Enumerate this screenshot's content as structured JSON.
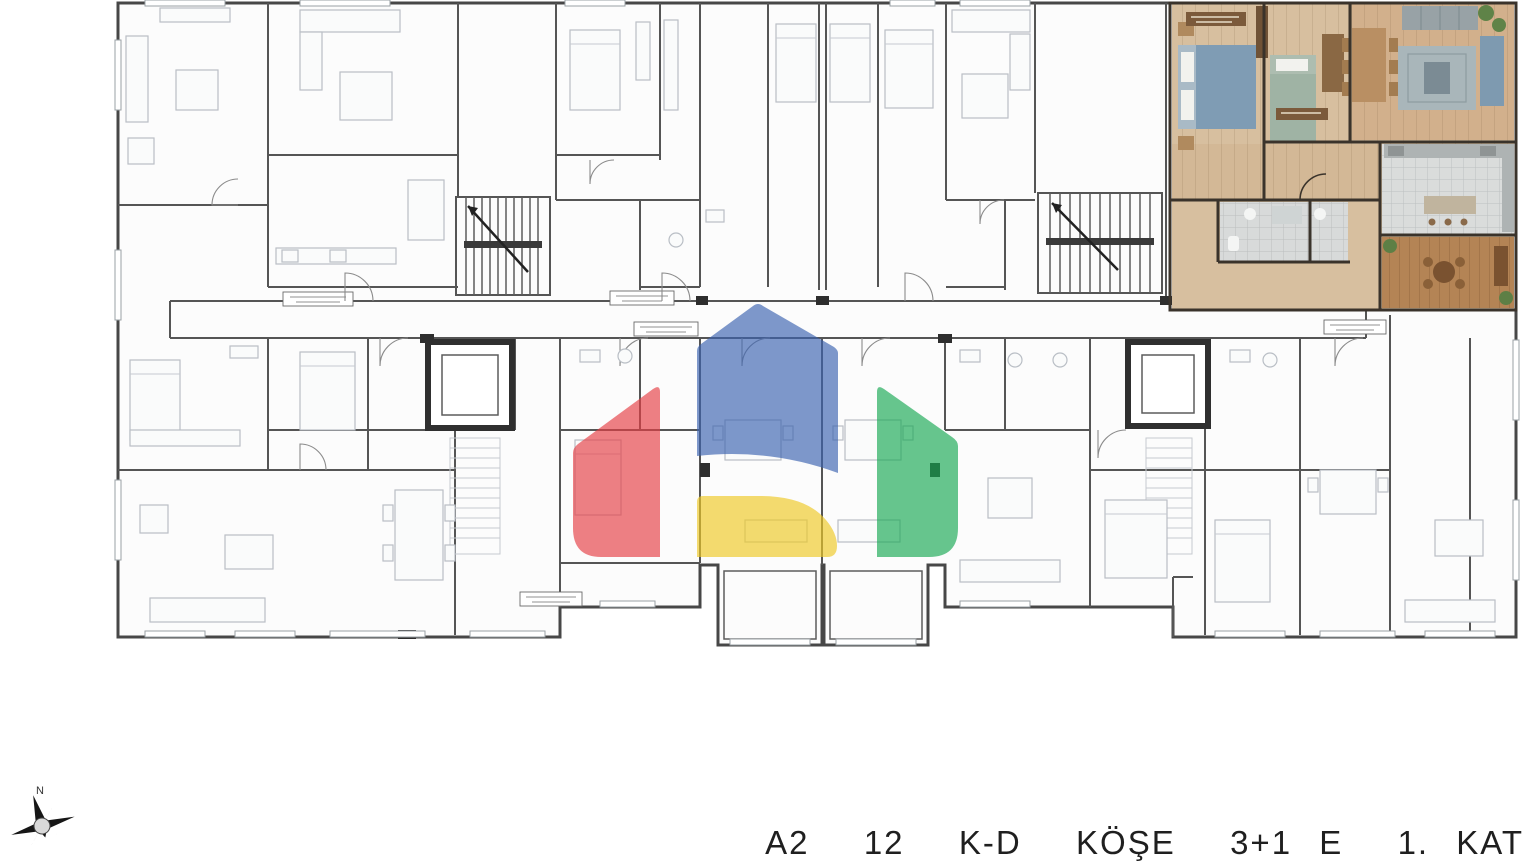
{
  "caption": {
    "text": "A2  12  K-D  KÖŞE  3+1 E  1. KAT"
  },
  "compass": {
    "north_label": "N"
  },
  "watermark": {
    "opacity": "0.66",
    "colors": {
      "blue": "#3b63b0",
      "red": "#e53e44",
      "yellow": "#eec825",
      "green": "#18a854"
    }
  },
  "plan": {
    "highlighted_unit": {
      "floor_color": "#d7bf9f",
      "living_color": "#d2b08c",
      "kitchen_color": "#dadcdb",
      "bath_color": "#d8dada",
      "balcony_color": "#b48455",
      "wall_color": "#3a332b",
      "bed_color": "#7f9cb4",
      "sofa_color": "#98a2a6"
    },
    "line_color": "#474747",
    "furniture_color": "#b9bec5"
  }
}
